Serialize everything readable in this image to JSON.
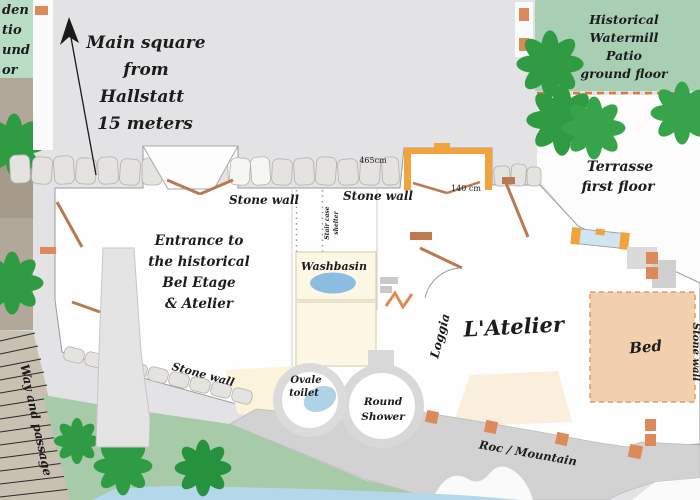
{
  "plan": {
    "type": "floor-plan",
    "labels": {
      "main_square": [
        "Main square",
        "from",
        "Hallstatt",
        "15 meters"
      ],
      "watermill": [
        "Historical",
        "Watermill",
        "Patio",
        "ground floor"
      ],
      "terrasse": [
        "Terrasse",
        "first floor"
      ],
      "entrance": [
        "Entrance to",
        "the historical",
        "Bel Etage",
        "& Atelier"
      ],
      "stone_wall_top_left": "Stone wall",
      "stone_wall_top_right": "Stone wall",
      "stone_wall_bottom": "Stone wall",
      "stone_wall_right_edge": "Stone wall",
      "staircase": [
        "Stair case",
        "shelter"
      ],
      "washbasin": "Washbasin",
      "loggia": "Loggia",
      "atelier": "L'Atelier",
      "bed": "Bed",
      "toilet": [
        "Ovale",
        "toilet"
      ],
      "shower": [
        "Round",
        "Shower"
      ],
      "roc": "Roc / Mountain",
      "passage": "Way and passage",
      "garden_fragments": [
        "den",
        "tio",
        "und",
        "or"
      ]
    },
    "measurements": {
      "wall_length": "465cm",
      "window_width": "140 cm"
    },
    "colors": {
      "background": "#e3e3e5",
      "patio_green": "#a8cfb4",
      "garden_green": "#b9dcc4",
      "grass": "#a7caa9",
      "tree": "#2f9b43",
      "rock_gray": "#d2d2d3",
      "water_blue": "#b4d7e9",
      "bed_peach": "#f2cfad",
      "cream_room": "#fdf8e6",
      "basin_blue": "#8cbce2",
      "window_orange": "#f2a33c",
      "door_brown": "#b97a52",
      "terracotta": "#dc8a5a",
      "dashed_line_orange": "#e0763c",
      "tan_path": "#b2a899",
      "hatch_band": "#c8c0b1"
    }
  }
}
